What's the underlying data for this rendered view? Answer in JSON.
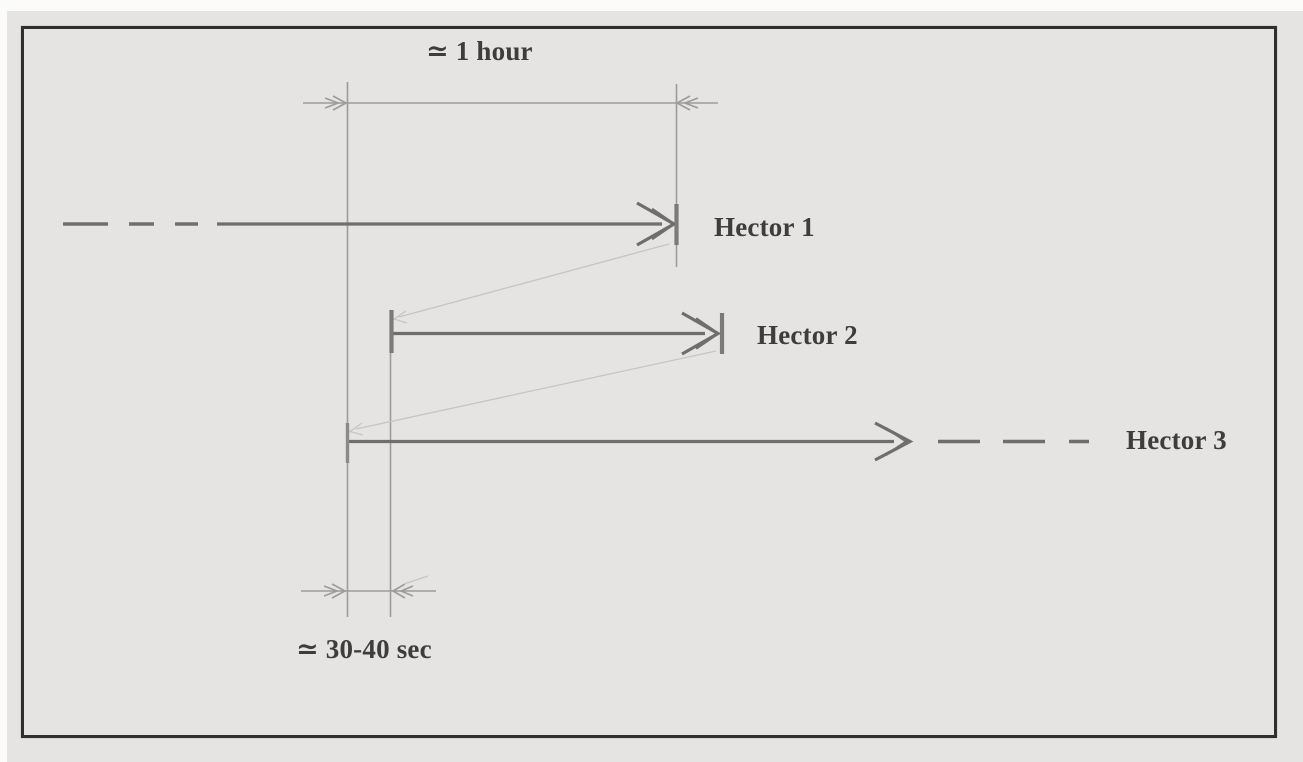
{
  "diagram": {
    "top_dimension_label": "≃ 1 hour",
    "bottom_dimension_label": "≃ 30-40 sec",
    "timelines": [
      {
        "label": "Hector 1"
      },
      {
        "label": "Hector 2"
      },
      {
        "label": "Hector 3"
      }
    ],
    "colors": {
      "background": "#e5e4e2",
      "frame_border": "#2f2f2f",
      "arrow_line": "#6e6e6e",
      "tick": "#7a7a7a",
      "thin_line": "#9b9b9b",
      "connector_line": "#c6c5c3",
      "text": "#3d3d3d"
    }
  }
}
